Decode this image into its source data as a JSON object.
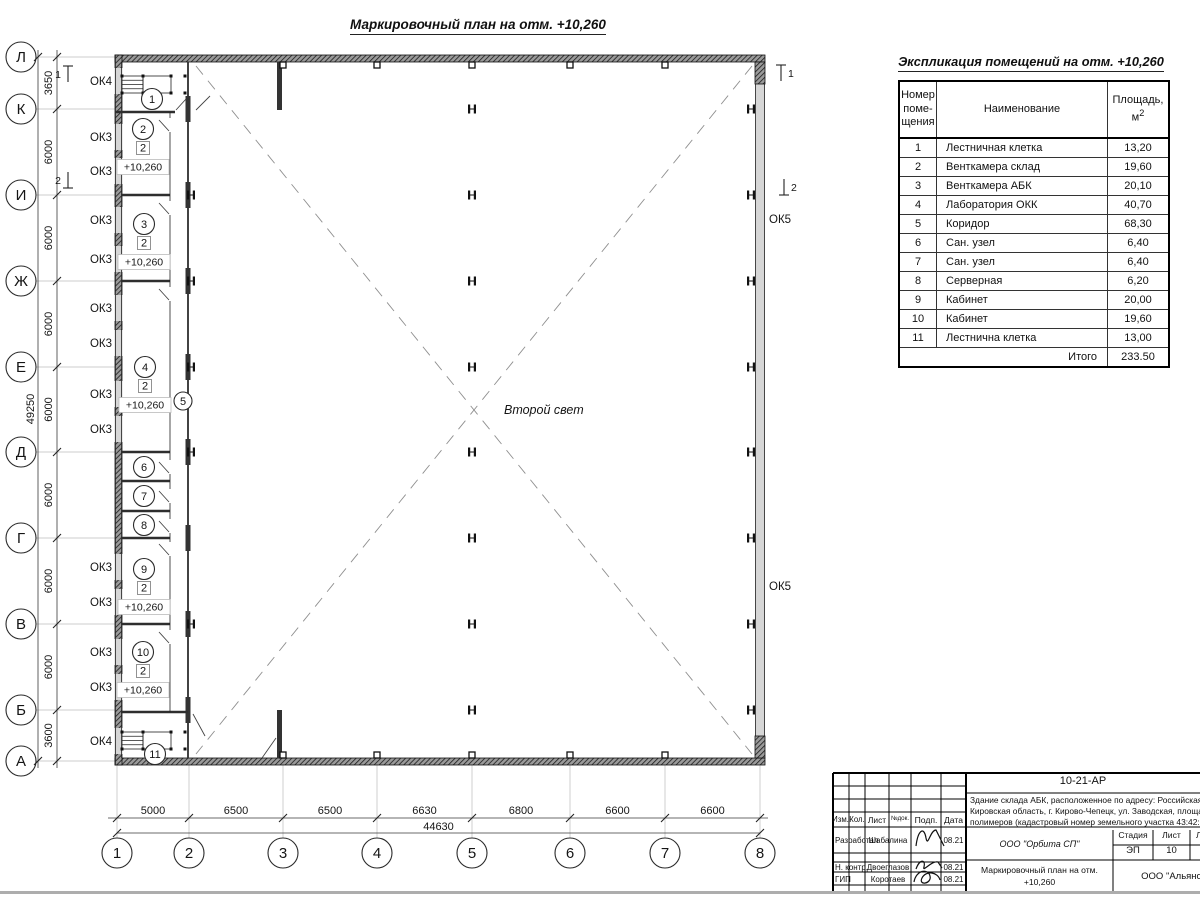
{
  "page": {
    "plan_title": "Маркировочный план на отм. +10,260",
    "second_light_label": "Второй свет"
  },
  "plan": {
    "rows": [
      [
        "Л",
        57
      ],
      [
        "К",
        109
      ],
      [
        "И",
        195
      ],
      [
        "Ж",
        281
      ],
      [
        "Е",
        367
      ],
      [
        "Д",
        452
      ],
      [
        "Г",
        538
      ],
      [
        "В",
        624
      ],
      [
        "Б",
        710
      ],
      [
        "А",
        761
      ]
    ],
    "cols": [
      [
        "1",
        117
      ],
      [
        "2",
        189
      ],
      [
        "3",
        283
      ],
      [
        "4",
        377
      ],
      [
        "5",
        472
      ],
      [
        "6",
        570
      ],
      [
        "7",
        665
      ],
      [
        "8",
        760
      ]
    ],
    "left_dim_segments": [
      "3650",
      "6000",
      "6000",
      "6000",
      "6000",
      "6000",
      "6000",
      "6000",
      "3600"
    ],
    "left_dim_total": "49250",
    "bottom_dim_segments": [
      "5000",
      "6500",
      "6500",
      "6630",
      "6800",
      "6600",
      "6600"
    ],
    "bottom_dim_total": "44630",
    "window_labels": [
      [
        "ОК4",
        81
      ],
      [
        "ОК3",
        137
      ],
      [
        "ОК3",
        171
      ],
      [
        "ОК3",
        220
      ],
      [
        "ОК3",
        259
      ],
      [
        "ОК3",
        308
      ],
      [
        "ОК3",
        343
      ],
      [
        "ОК3",
        394
      ],
      [
        "ОК3",
        429
      ],
      [
        "ОК3",
        567
      ],
      [
        "ОК3",
        602
      ],
      [
        "ОК3",
        652
      ],
      [
        "ОК3",
        687
      ],
      [
        "ОК4",
        741
      ]
    ],
    "right_window_labels": [
      [
        "ОК5",
        219
      ],
      [
        "ОК5",
        586
      ]
    ],
    "room_markers": [
      {
        "num": "1",
        "x": 152,
        "y": 99
      },
      {
        "num": "2",
        "x": 143,
        "y": 129,
        "type": "2",
        "elev": "+10,260"
      },
      {
        "num": "3",
        "x": 144,
        "y": 224,
        "type": "2",
        "elev": "+10,260"
      },
      {
        "num": "4",
        "x": 145,
        "y": 367,
        "type": "2",
        "elev": "+10,260"
      },
      {
        "num": "5",
        "x": 183,
        "y": 401
      },
      {
        "num": "6",
        "x": 144,
        "y": 467
      },
      {
        "num": "7",
        "x": 144,
        "y": 496
      },
      {
        "num": "8",
        "x": 144,
        "y": 525
      },
      {
        "num": "9",
        "x": 144,
        "y": 569,
        "type": "2",
        "elev": "+10,260"
      },
      {
        "num": "10",
        "x": 143,
        "y": 652,
        "type": "2",
        "elev": "+10,260"
      },
      {
        "num": "11",
        "x": 155,
        "y": 754
      }
    ],
    "section_marks": [
      {
        "num": "1",
        "x": 68,
        "y": 74,
        "dir": "up",
        "side": "left"
      },
      {
        "num": "2",
        "x": 68,
        "y": 180,
        "dir": "down",
        "side": "left"
      },
      {
        "num": "1",
        "x": 781,
        "y": 73,
        "dir": "up",
        "side": "right"
      },
      {
        "num": "2",
        "x": 784,
        "y": 187,
        "dir": "down",
        "side": "right"
      }
    ]
  },
  "schedule": {
    "title": "Экспликация помещений на отм. +10,260",
    "col1_header_lines": [
      "Номер",
      "поме-",
      "щения"
    ],
    "col2_header": "Наименование",
    "col3_header_text": "Площадь,",
    "col3_header_unit": "м",
    "col3_header_sup": "2",
    "rows": [
      [
        "1",
        "Лестничная клетка",
        "13,20"
      ],
      [
        "2",
        "Венткамера склад",
        "19,60"
      ],
      [
        "3",
        "Венткамера АБК",
        "20,10"
      ],
      [
        "4",
        "Лаборатория ОКК",
        "40,70"
      ],
      [
        "5",
        "Коридор",
        "68,30"
      ],
      [
        "6",
        "Сан. узел",
        "6,40"
      ],
      [
        "7",
        "Сан. узел",
        "6,40"
      ],
      [
        "8",
        "Серверная",
        "6,20"
      ],
      [
        "9",
        "Кабинет",
        "20,00"
      ],
      [
        "10",
        "Кабинет",
        "19,60"
      ],
      [
        "11",
        "Лестнична клетка",
        "13,00"
      ]
    ],
    "total_label": "Итого",
    "total_value": "233.50"
  },
  "title_block": {
    "doc_code": "10-21-АР",
    "address_lines": [
      "Здание склада АБК, расположенное по адресу: Российская Феде",
      "Кировская область, г. Кирово-Чепецк, ул. Заводская, площадка з",
      "полимеров (кадастровый номер земельного участка 43:42:0000"
    ],
    "col_headers": [
      "Изм.",
      "Кол.",
      "Лист",
      "№док.",
      "Подп.",
      "Дата"
    ],
    "signature_rows": [
      {
        "role": "Разработал",
        "name": "Шабалина",
        "date": "08.21"
      },
      {
        "role": "Н. контр.",
        "name": "Двоеглазов",
        "date": "08.21"
      },
      {
        "role": "ГИП",
        "name": "Коротаев",
        "date": "08.21"
      }
    ],
    "org": "ООО \"Орбита СП\"",
    "stage_headers": [
      "Стадия",
      "Лист",
      "Листов"
    ],
    "stage": "ЭП",
    "sheet": "10",
    "sheets": "1",
    "sheet_title_lines": [
      "Маркировочный план на отм.",
      "+10,260"
    ],
    "org2": "ООО \"Альяно"
  }
}
